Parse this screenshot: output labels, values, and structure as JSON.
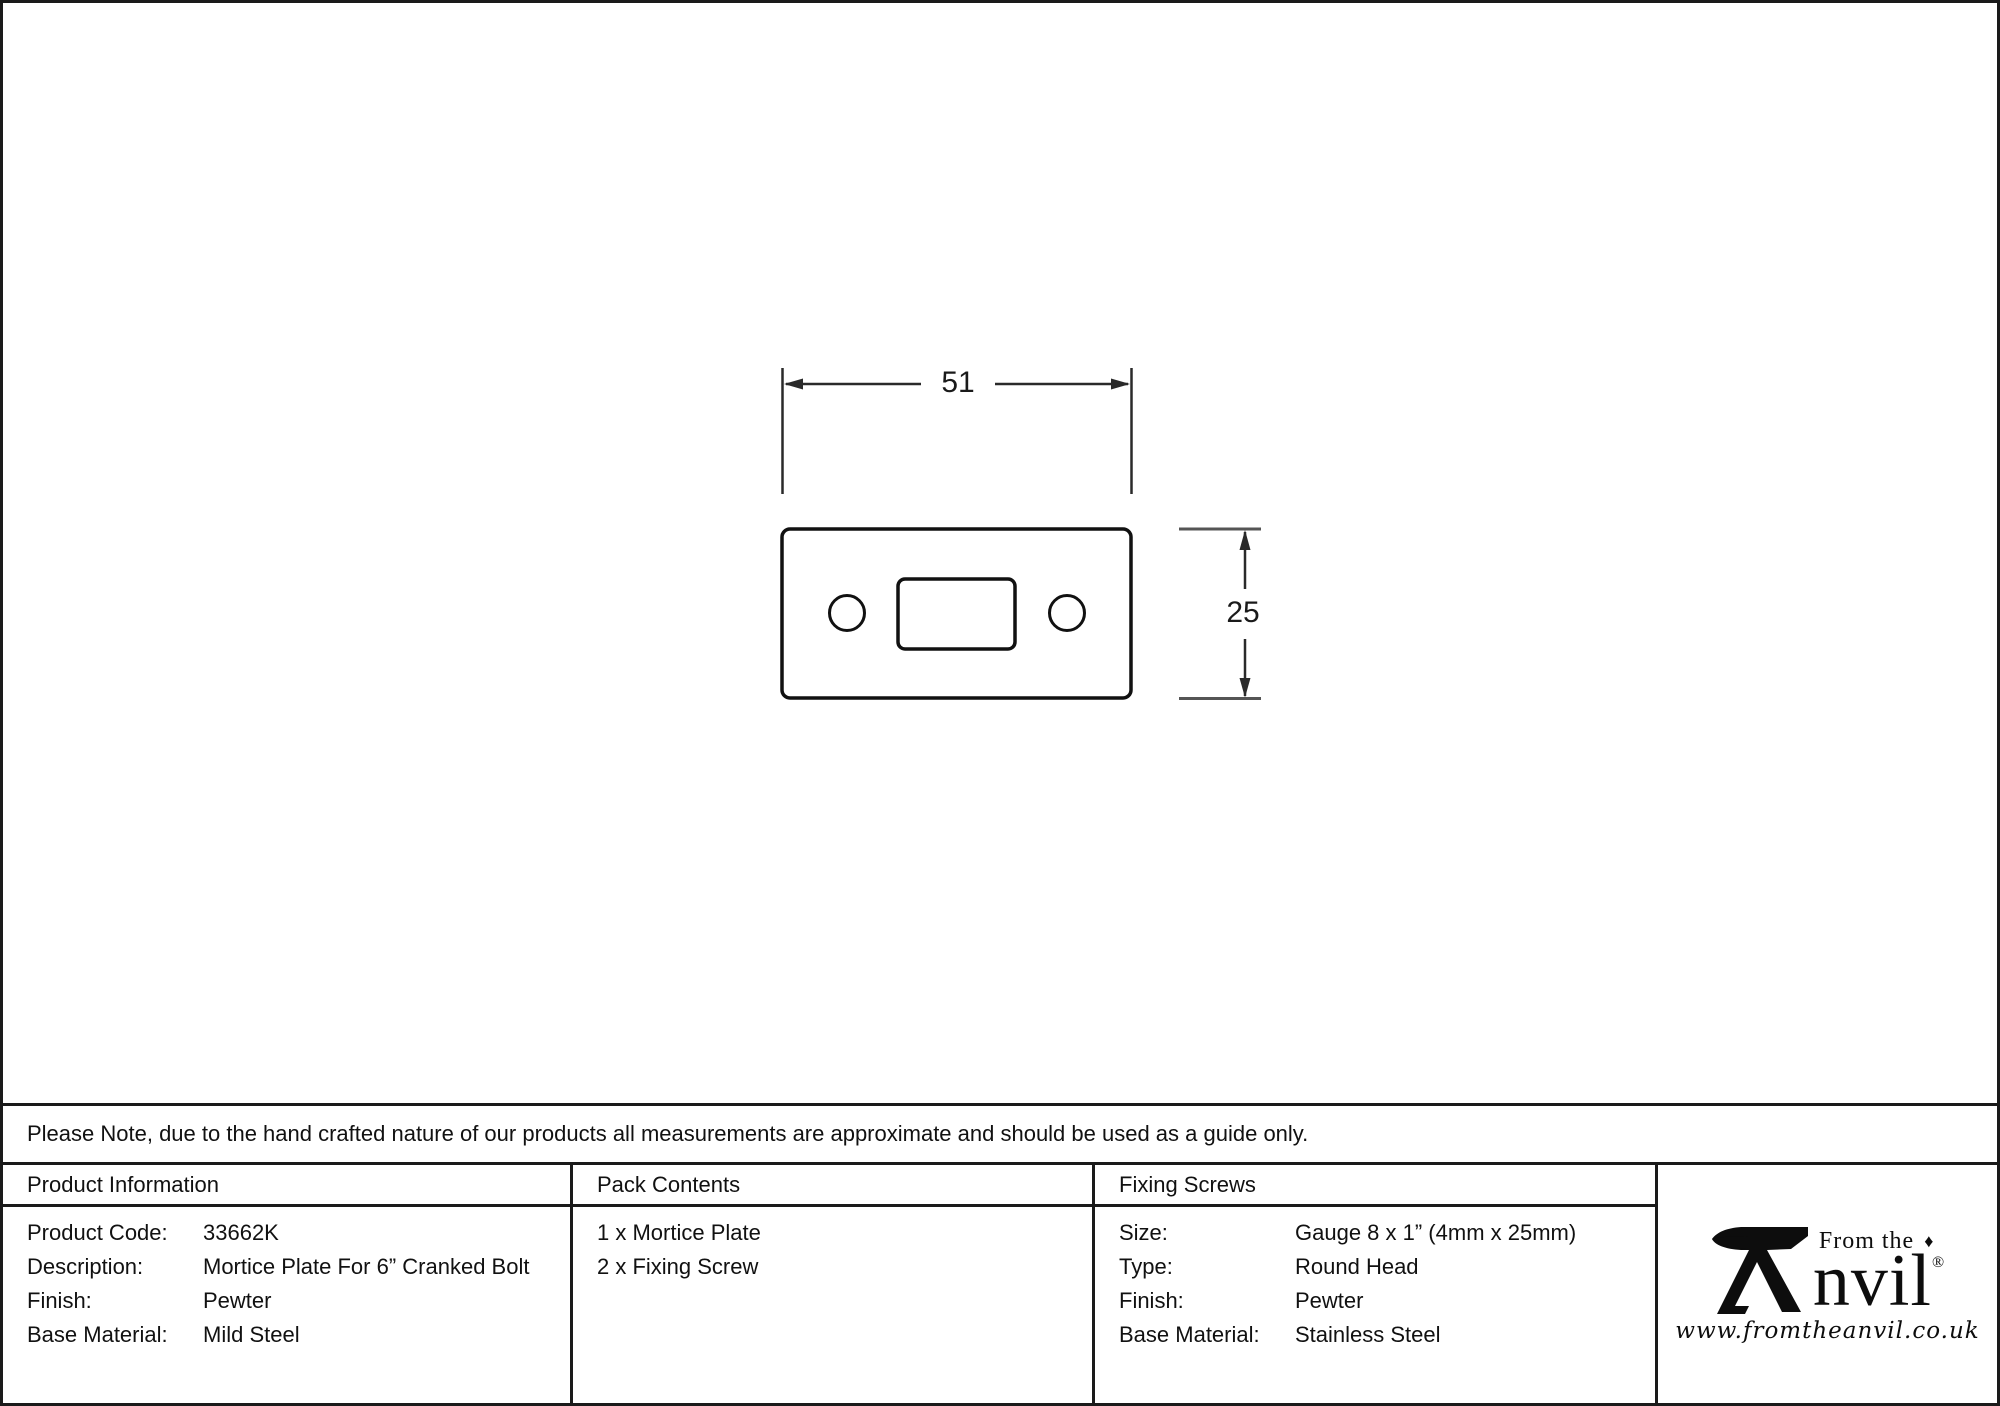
{
  "drawing": {
    "width_dim": "51",
    "height_dim": "25"
  },
  "note": {
    "text": "Please Note, due to the hand crafted nature of our products all measurements are approximate and should be used as a guide only."
  },
  "tables": {
    "product_information": {
      "header": "Product Information",
      "rows": [
        {
          "label": "Product Code:",
          "value": "33662K"
        },
        {
          "label": "Description:",
          "value": "Mortice Plate For 6” Cranked Bolt"
        },
        {
          "label": "Finish:",
          "value": "Pewter"
        },
        {
          "label": "Base Material:",
          "value": "Mild Steel"
        }
      ]
    },
    "pack_contents": {
      "header": "Pack Contents",
      "items": [
        "1 x Mortice Plate",
        "2 x Fixing Screw"
      ]
    },
    "fixing_screws": {
      "header": "Fixing Screws",
      "rows": [
        {
          "label": "Size:",
          "value": "Gauge 8 x 1” (4mm x 25mm)"
        },
        {
          "label": "Type:",
          "value": "Round Head"
        },
        {
          "label": "Finish:",
          "value": "Pewter"
        },
        {
          "label": "Base Material:",
          "value": "Stainless Steel"
        }
      ]
    }
  },
  "logo": {
    "top_text": "From the",
    "diamond": "♦",
    "name": "nvil",
    "registered": "®",
    "url": "www.fromtheanvil.co.uk"
  },
  "colors": {
    "ink": "#1a1a1a",
    "background": "#ffffff"
  }
}
